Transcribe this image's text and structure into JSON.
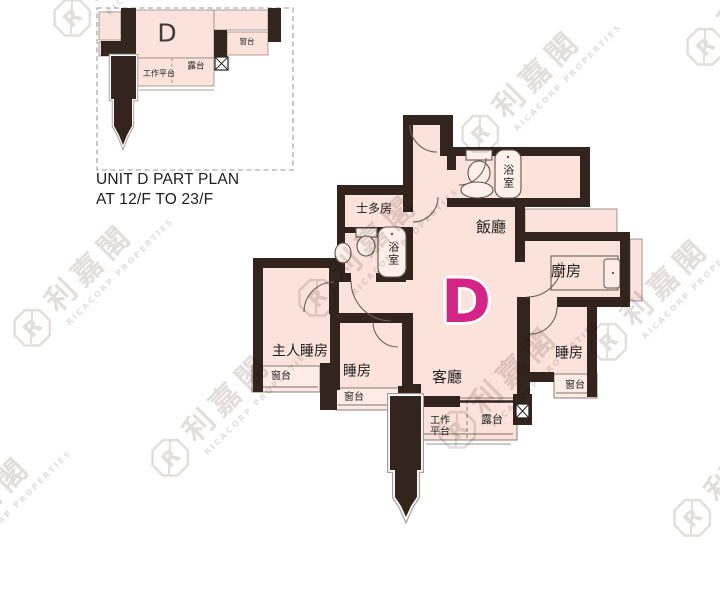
{
  "inset": {
    "unit_letter": "D",
    "caption_line1": "UNIT D PART PLAN",
    "caption_line2": "AT 12/F TO 23/F",
    "labels": {
      "balcony": "露台",
      "utility_platform": "工作平台",
      "bay_window": "窗台"
    }
  },
  "plan": {
    "unit_letter": "D",
    "rooms": {
      "dining": "飯廳",
      "kitchen": "廚房",
      "store": "士多房",
      "bath_top": "浴室",
      "bath_inner": "浴室",
      "master_bedroom": "主人睡房",
      "living": "客廳",
      "bedroom_middle": "睡房",
      "bedroom_right": "睡房",
      "balcony": "露台",
      "utility_platform": "工作平台",
      "bay_window_master": "窗台",
      "bay_window_middle": "窗台",
      "bay_window_right": "窗台"
    }
  },
  "watermark": {
    "logo_letter": "R",
    "cjk_name": "利嘉閣",
    "latin_name": "RICACORP PROPERTIES"
  },
  "colors": {
    "accent": "#d62486",
    "wall": "#33241e",
    "room_fill": "#fbe2da"
  }
}
